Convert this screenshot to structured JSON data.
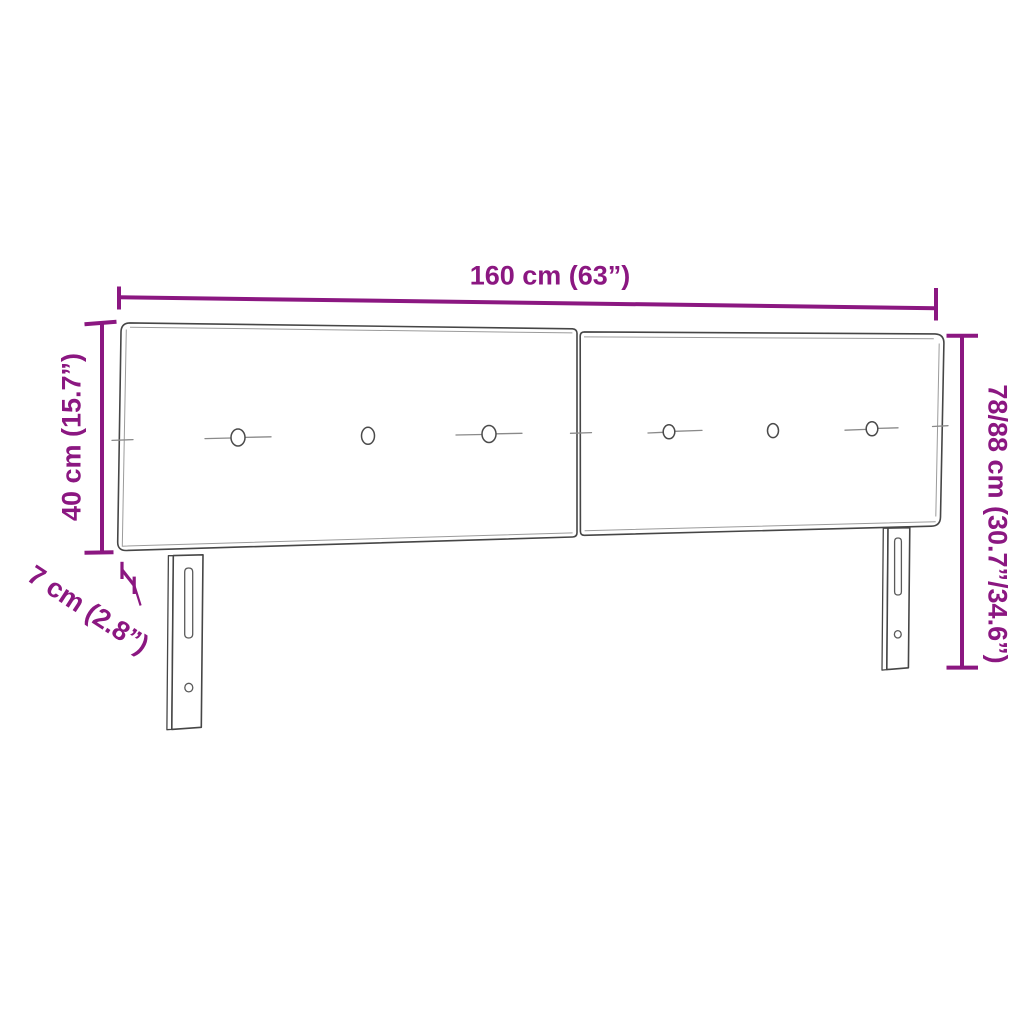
{
  "diagram": {
    "type": "product-dimension-diagram",
    "subject": "two-panel upholstered headboard with six buttons and two slotted legs",
    "dimensions": {
      "width": {
        "label": "160 cm (63”)"
      },
      "panel_height": {
        "label": "40 cm (15.7”)"
      },
      "depth": {
        "label": "7 cm (2.8”)"
      },
      "total_height": {
        "label": "78/88 cm (30.7”/34.6”)"
      }
    },
    "colors": {
      "dimension_accent": "#8B1781",
      "drawing_outline": "#464646",
      "background": "#FFFFFF"
    }
  }
}
